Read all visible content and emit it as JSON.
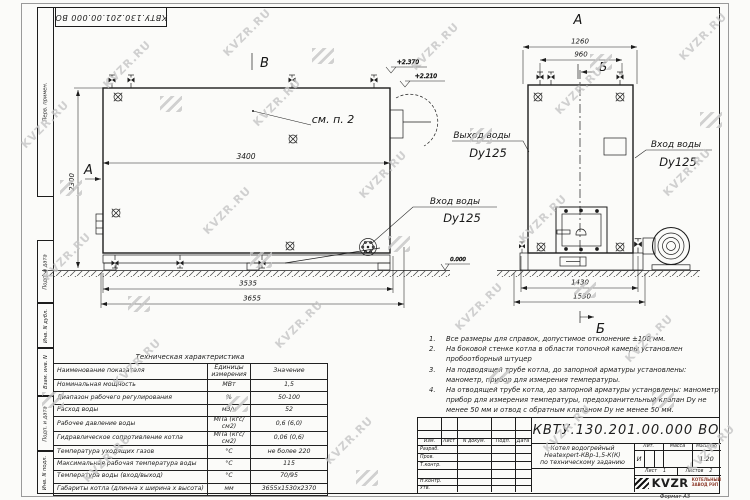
{
  "watermark": {
    "text": "KVZR.RU"
  },
  "stamp": {
    "number": "КВТУ.130.201.00.000  ВО"
  },
  "margin_labels": {
    "box1": "Перв. примен.",
    "box2": "Подп. и дата",
    "box3": "Инв. N дубл.",
    "box4": "Взам. инв. N",
    "box5": "Подп. и дата",
    "box6": "Инв. N подл."
  },
  "side_view": {
    "view_label_top": "В",
    "view_label_left": "А",
    "dim_length": "3400",
    "dim_height": "2300",
    "dim_base": "3535",
    "dim_overall": "3655",
    "elev_top": "+2.370",
    "elev_mid": "+2.210",
    "elev_zero": "0.000",
    "note_ref": "см. п. 2",
    "inlet_line1": "Вход воды",
    "inlet_line2": "Dy125"
  },
  "front_view": {
    "view_label_top": "А",
    "section_label_top": "Б",
    "section_label_bottom": "Б",
    "dim_top_outer": "1260",
    "dim_top_inner": "960",
    "dim_base_inner": "1430",
    "dim_base_outer": "1530",
    "outlet_line1": "Выход воды",
    "outlet_line2": "Dy125",
    "inlet_line1": "Вход воды",
    "inlet_line2": "Dy125"
  },
  "notes": {
    "items": [
      {
        "num": "1.",
        "text": "Все размеры для справок, допустимое отклонение ±100 мм."
      },
      {
        "num": "2.",
        "text": "На боковой стенке котла в области топочной камеры установлен пробоотборный штуцер"
      },
      {
        "num": "3.",
        "text": "На подводящей трубе котла, до запорной арматуры установлены: манометр, прибор для измерения температуры."
      },
      {
        "num": "4.",
        "text": "На отводящей трубе котла, до запорной арматуры установлены: манометр, прибор для измерения температуры, предохранительный клапан Dу не менее 50 мм и отвод с обратным клапаном Dу не менее 50 мм."
      }
    ]
  },
  "spec_table": {
    "title": "Техническая характеристика",
    "col_name": "Наименование показателя",
    "col_units": "Единицы измерения",
    "col_value": "Значение",
    "rows": [
      {
        "name": "Номинальная мощность",
        "units": "МВт",
        "value": "1,5"
      },
      {
        "name": "Диапазон рабочего регулирования",
        "units": "%",
        "value": "50-100"
      },
      {
        "name": "Расход воды",
        "units": "м3/ч",
        "value": "52"
      },
      {
        "name": "Рабочее давление воды",
        "units": "МПа (кгс/см2)",
        "value": "0,6 (6,0)"
      },
      {
        "name": "Гидравлическое сопротивление котла",
        "units": "МПа (кгс/см2)",
        "value": "0,06 (0,6)"
      },
      {
        "name": "Температура уходящих газов",
        "units": "°С",
        "value": "не более 220"
      },
      {
        "name": "Максимальная рабочая температура воды",
        "units": "°С",
        "value": "115"
      },
      {
        "name": "Температура воды (вход/выход)",
        "units": "°С",
        "value": "70/95"
      },
      {
        "name": "Габариты котла (длинна х ширина х высота)",
        "units": "мм",
        "value": "3655х1530х2370"
      }
    ]
  },
  "title_block": {
    "doc_number": "КВТУ.130.201.00.000  ВО",
    "col_izm": "Изм.",
    "col_list": "Лист",
    "col_ndoc": "N докум.",
    "col_podp": "Подп.",
    "col_data": "Дата",
    "row_razrab": "Разраб.",
    "row_prov": "Пров.",
    "row_tkontr": "Т.контр.",
    "row_nkontr": "Н.контр.",
    "row_utv": "Утв.",
    "desc1": "Котел водогрейный",
    "desc2": "Heatexpert-КВр-1,5-К(К)",
    "desc3": "по техническому заданию",
    "lit_h": "Лит.",
    "mass_h": "Масса",
    "scale_h": "Масштаб",
    "lit_v": "И",
    "scale_v": "1:20",
    "sheet_label": "Лист",
    "sheet_num": "1",
    "sheets_label": "Листов",
    "sheets_num": "2",
    "logo_text": "KVZR",
    "logo_sub1": "КОТЕЛЬНЫЙ",
    "logo_sub2": "ЗАВОД РЭП",
    "format_label": "Формат   А3"
  },
  "colors": {
    "line": "#1d1d1d",
    "paper": "#fbfbf9",
    "watermark": "#c6c6c6",
    "logo_accent": "#8d3b2b"
  }
}
